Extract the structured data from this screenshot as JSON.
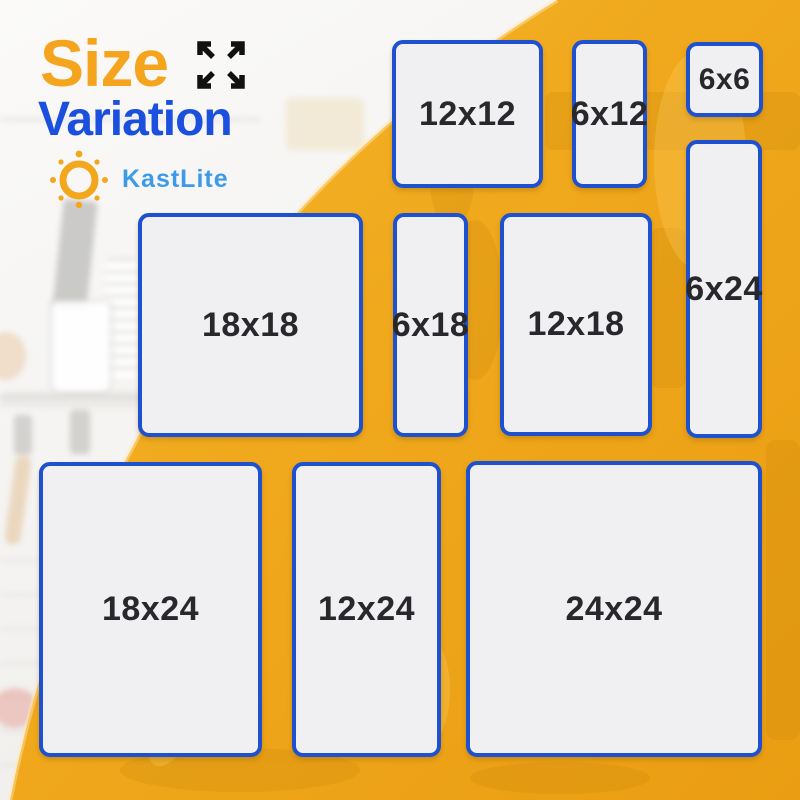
{
  "header": {
    "title_word_1": "Size",
    "title_word_2": "Variation",
    "brand_name": "KastLite"
  },
  "icons": {
    "expand": "expand-arrows-icon",
    "sun": "sun-logo-icon"
  },
  "panels": [
    {
      "label": "12x12",
      "width_in": 12,
      "height_in": 12
    },
    {
      "label": "6x12",
      "width_in": 6,
      "height_in": 12
    },
    {
      "label": "6x6",
      "width_in": 6,
      "height_in": 6
    },
    {
      "label": "6x24",
      "width_in": 6,
      "height_in": 24
    },
    {
      "label": "18x18",
      "width_in": 18,
      "height_in": 18
    },
    {
      "label": "6x18",
      "width_in": 6,
      "height_in": 18
    },
    {
      "label": "12x18",
      "width_in": 12,
      "height_in": 18
    },
    {
      "label": "18x24",
      "width_in": 18,
      "height_in": 24
    },
    {
      "label": "12x24",
      "width_in": 12,
      "height_in": 24
    },
    {
      "label": "24x24",
      "width_in": 24,
      "height_in": 24
    }
  ],
  "colors": {
    "title_orange": "#F5A41D",
    "title_blue": "#1B50DF",
    "brand_blue": "#3D9AE9",
    "overlay_yellow": "#F0A81C",
    "panel_fill": "#F0F0F2",
    "panel_border": "#1D51CF",
    "panel_label": "#28282C"
  }
}
